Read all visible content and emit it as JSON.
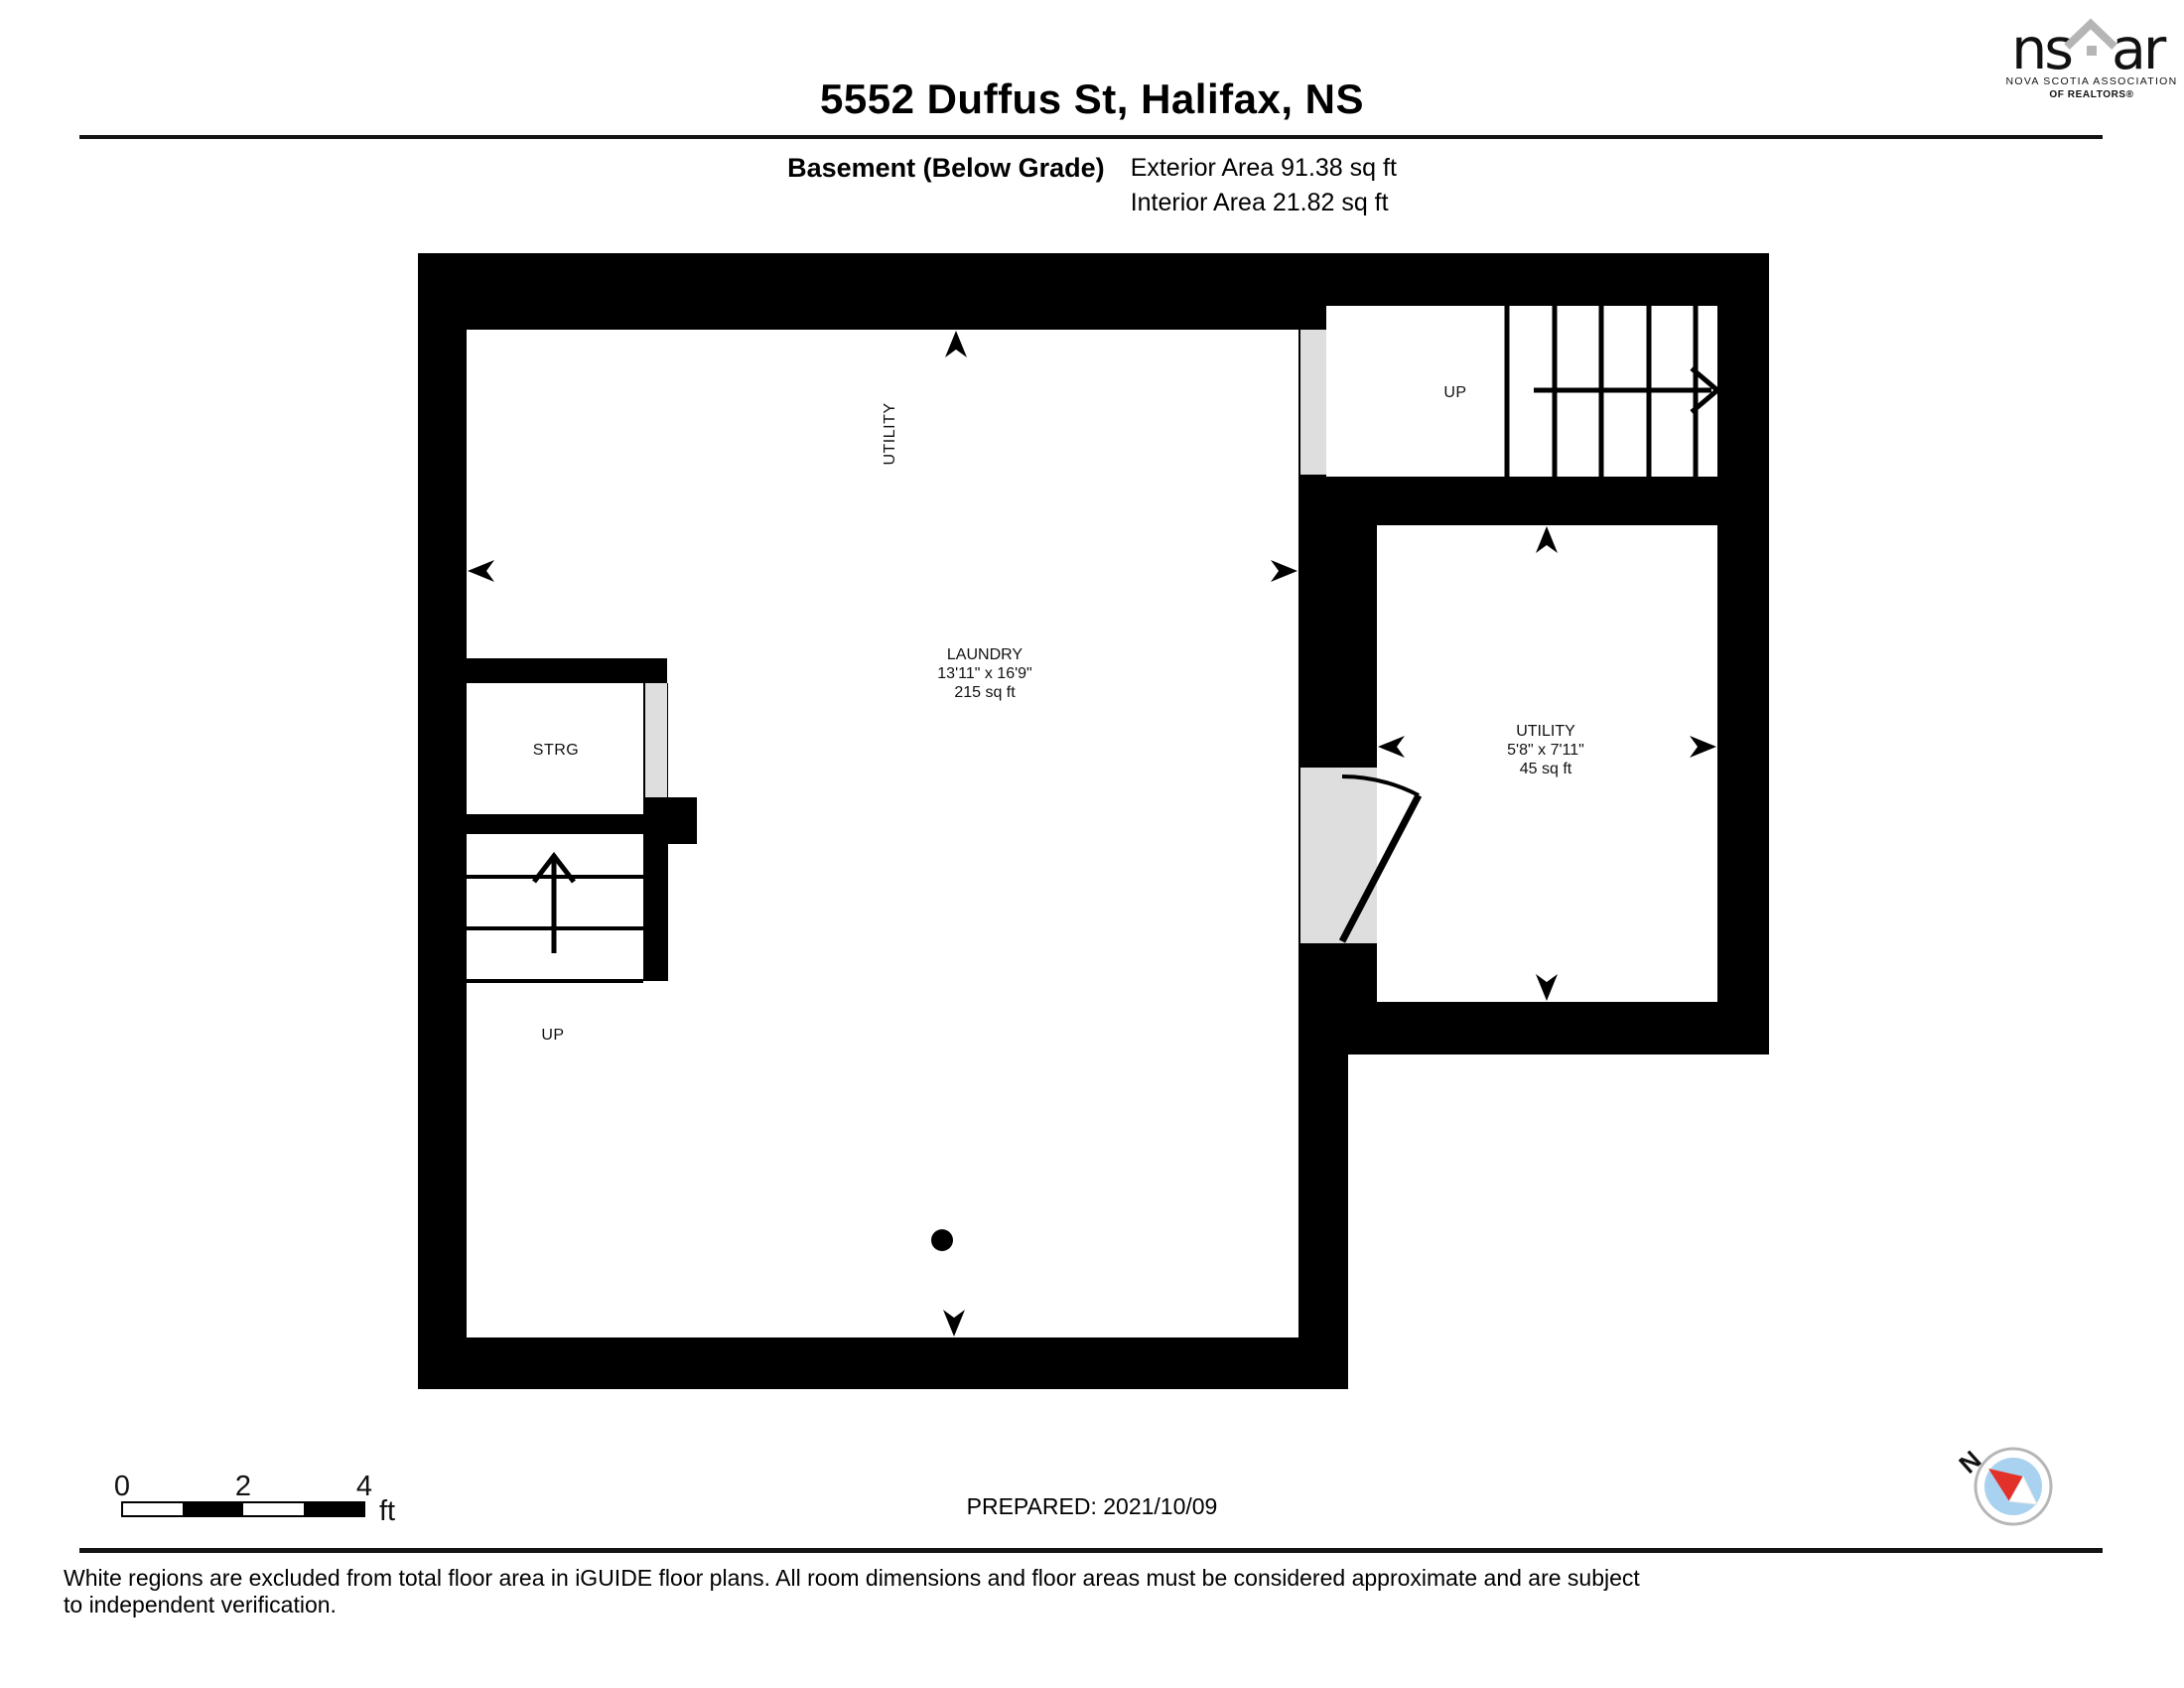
{
  "header": {
    "title": "5552 Duffus St, Halifax, NS",
    "floor_label": "Basement (Below Grade)",
    "exterior_area": "Exterior Area 91.38 sq ft",
    "interior_area": "Interior Area 21.82 sq ft",
    "logo": {
      "name_left": "ns",
      "name_right": "ar",
      "subline1": "NOVA SCOTIA ASSOCIATION",
      "subline2": "OF REALTORS®"
    }
  },
  "plan": {
    "laundry": {
      "name": "LAUNDRY",
      "dims": "13'11\" x 16'9\"",
      "area": "215 sq ft"
    },
    "utility_room": {
      "name": "UTILITY",
      "dims": "5'8\" x 7'11\"",
      "area": "45 sq ft"
    },
    "utility_zone_label": "UTILITY",
    "storage_label": "STRG",
    "stairs_left_label": "UP",
    "stairs_right_label": "UP"
  },
  "footer": {
    "scale_ticks": [
      "0",
      "2",
      "4"
    ],
    "scale_unit": "ft",
    "prepared": "PREPARED: 2021/10/09",
    "compass_north": "N",
    "disclaimer": "White regions are excluded from total floor area in iGUIDE floor plans. All room dimensions and floor areas must be considered approximate and are subject to independent verification."
  },
  "colors": {
    "wall": "#000000",
    "opening_gray": "#dedede",
    "logo_gray": "#b5b5b5",
    "compass_ring": "#b6b6b6",
    "compass_blue": "#a8d2ef",
    "compass_red": "#e23128"
  }
}
